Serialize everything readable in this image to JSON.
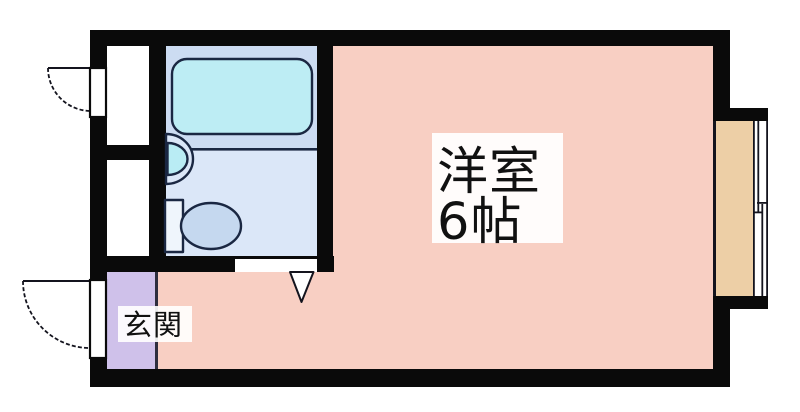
{
  "floorplan": {
    "kind": "japanese-apartment-floor-plan",
    "rooms": {
      "main_room": {
        "name_line1": "洋室",
        "name_line2": "6帖",
        "floor_color": "#f8cfc3"
      },
      "entrance": {
        "name": "玄関",
        "floor_color": "#cfc1ea"
      },
      "bathroom": {
        "bath_zone_color": "#ccdcf2",
        "toilet_zone_color": "#dbe7f8"
      },
      "bay_window": {
        "floor_color": "#edcfa6",
        "glazing_color": "#ffffff"
      },
      "side_alcoves": {
        "floor_color": "#ffffff"
      }
    },
    "fixtures": {
      "bathtub_fill": "#bdedf4",
      "sink_counter_fill": "#dbe7f8",
      "sink_bowl_fill": "#b9ecf4",
      "toilet_bowl_fill": "#c5d8ef",
      "toilet_tank_fill": "#eff5fc"
    },
    "colors": {
      "wall": "#0a0a0a",
      "fixture_stroke": "#1a2742",
      "thin_line": "#14141e",
      "step_line": "#2e2e3e",
      "opening_fill": "#ffffff",
      "label_bg": "#ffffff",
      "label_text": "#111111",
      "canvas_bg": "#ffffff"
    }
  }
}
